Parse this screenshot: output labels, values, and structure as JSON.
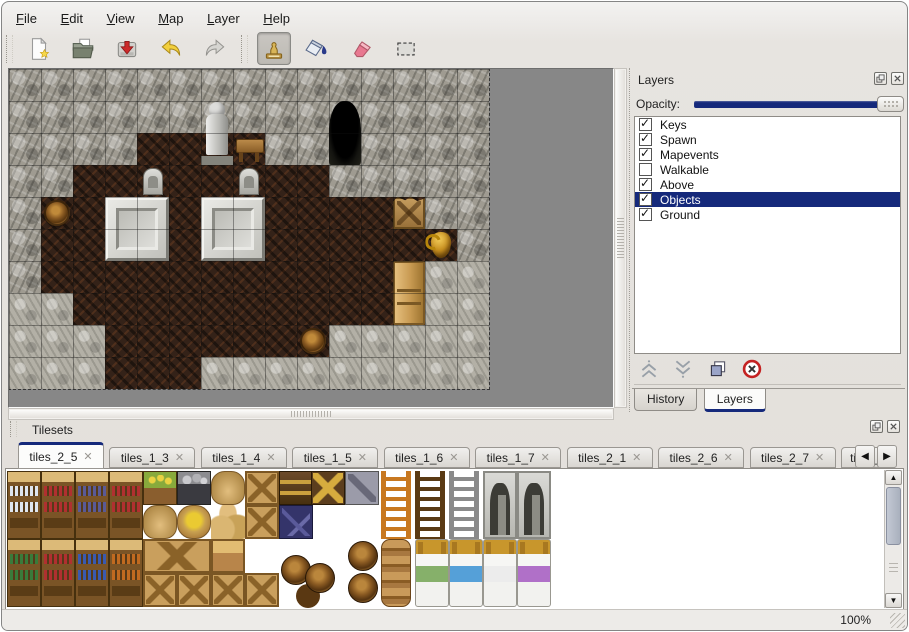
{
  "menu": {
    "items": [
      {
        "key": "F",
        "rest": "ile"
      },
      {
        "key": "E",
        "rest": "dit"
      },
      {
        "key": "V",
        "rest": "iew"
      },
      {
        "key": "M",
        "rest": "ap"
      },
      {
        "key": "L",
        "rest": "ayer"
      },
      {
        "key": "H",
        "rest": "elp"
      }
    ]
  },
  "toolbar": {
    "buttons": [
      {
        "icon": "new-file-icon"
      },
      {
        "icon": "open-folder-icon"
      },
      {
        "icon": "save-icon"
      },
      {
        "icon": "undo-icon"
      },
      {
        "icon": "redo-icon"
      },
      {
        "icon": "stamp-tool-icon",
        "active": true
      },
      {
        "icon": "fill-tool-icon"
      },
      {
        "icon": "eraser-tool-icon"
      },
      {
        "icon": "select-tool-icon"
      }
    ]
  },
  "layers_panel": {
    "title": "Layers",
    "opacity_label": "Opacity:",
    "opacity_percent": 100,
    "items": [
      {
        "label": "Keys",
        "checked": true,
        "selected": false
      },
      {
        "label": "Spawn",
        "checked": true,
        "selected": false
      },
      {
        "label": "Mapevents",
        "checked": true,
        "selected": false
      },
      {
        "label": "Walkable",
        "checked": false,
        "selected": false
      },
      {
        "label": "Above",
        "checked": true,
        "selected": false
      },
      {
        "label": "Objects",
        "checked": true,
        "selected": true
      },
      {
        "label": "Ground",
        "checked": true,
        "selected": false
      }
    ],
    "buttons": [
      "move-layer-up",
      "move-layer-down",
      "duplicate-layer",
      "delete-layer"
    ],
    "tabs": [
      {
        "label": "History",
        "active": false
      },
      {
        "label": "Layers",
        "active": true
      }
    ]
  },
  "tilesets_panel": {
    "title": "Tilesets",
    "tabs": [
      {
        "label": "tiles_2_5",
        "active": true
      },
      {
        "label": "tiles_1_3",
        "active": false
      },
      {
        "label": "tiles_1_4",
        "active": false
      },
      {
        "label": "tiles_1_5",
        "active": false
      },
      {
        "label": "tiles_1_6",
        "active": false
      },
      {
        "label": "tiles_1_7",
        "active": false
      },
      {
        "label": "tiles_2_1",
        "active": false
      },
      {
        "label": "tiles_2_6",
        "active": false
      },
      {
        "label": "tiles_2_7",
        "active": false
      },
      {
        "label": "tiles_",
        "active": false
      }
    ]
  },
  "status": {
    "zoom": "100%"
  },
  "colors": {
    "accent": "#15297b",
    "canvas_bg": "#878787"
  },
  "map": {
    "tile_size": 32,
    "legend": {
      "W": "rock-wall",
      "F": "wood-floor",
      "R": "rock-ground"
    },
    "grid": [
      "WWWWWWWWWWWWWWW",
      "WWWWWWWWWWWWWWW",
      "WWWWFFFFWWWWWWW",
      "WWFFFFFFFFWWWWW",
      "WFFFFFFFFFFFFWW",
      "WFFFFFFFFFFFFFW",
      "WFFFFFFFFFFFFRR",
      "RRFFFFFFFFFFFRR",
      "RRRFFFFFFFRRRRR",
      "RRRFFFRRRRRRRRR"
    ],
    "objects": [
      {
        "type": "statue",
        "col": 6,
        "row": 1,
        "w": 1,
        "h": 2
      },
      {
        "type": "table",
        "col": 7,
        "row": 2,
        "w": 1,
        "h": 1
      },
      {
        "type": "cave",
        "col": 10,
        "row": 1,
        "w": 1,
        "h": 2
      },
      {
        "type": "tombstone",
        "col": 4,
        "row": 3,
        "w": 1,
        "h": 1
      },
      {
        "type": "tombstone",
        "col": 7,
        "row": 3,
        "w": 1,
        "h": 1
      },
      {
        "type": "platform",
        "col": 3,
        "row": 4,
        "w": 2,
        "h": 2
      },
      {
        "type": "platform",
        "col": 6,
        "row": 4,
        "w": 2,
        "h": 2
      },
      {
        "type": "barrel",
        "col": 1,
        "row": 4,
        "w": 1,
        "h": 1
      },
      {
        "type": "crate-broken",
        "col": 12,
        "row": 4,
        "w": 1,
        "h": 1
      },
      {
        "type": "vase",
        "col": 13,
        "row": 5,
        "w": 1,
        "h": 1
      },
      {
        "type": "cabinet",
        "col": 12,
        "row": 6,
        "w": 1,
        "h": 2
      },
      {
        "type": "barrel",
        "col": 9,
        "row": 8,
        "w": 1,
        "h": 1
      }
    ]
  },
  "palette": {
    "items": [
      {
        "type": "shelf",
        "x": 0,
        "y": 0,
        "w": 34,
        "h": 68,
        "accent": "#dfe5ee"
      },
      {
        "type": "shelf",
        "x": 34,
        "y": 0,
        "w": 34,
        "h": 68,
        "accent": "#b03030"
      },
      {
        "type": "shelf",
        "x": 68,
        "y": 0,
        "w": 34,
        "h": 68,
        "accent": "#5a5a96"
      },
      {
        "type": "shelf",
        "x": 102,
        "y": 0,
        "w": 34,
        "h": 68,
        "accent": "#b03030"
      },
      {
        "type": "planter",
        "x": 136,
        "y": 0
      },
      {
        "type": "orecart",
        "x": 170,
        "y": 0
      },
      {
        "type": "sack",
        "x": 204,
        "y": 0
      },
      {
        "type": "crate",
        "x": 238,
        "y": 0
      },
      {
        "type": "chestdark",
        "x": 272,
        "y": 0
      },
      {
        "type": "chestgold",
        "x": 304,
        "y": 0
      },
      {
        "type": "cratemark",
        "x": 338,
        "y": 0
      },
      {
        "type": "sackbig",
        "x": 136,
        "y": 34
      },
      {
        "type": "sackopen",
        "x": 170,
        "y": 34
      },
      {
        "type": "sackpile",
        "x": 204,
        "y": 34
      },
      {
        "type": "crate",
        "x": 238,
        "y": 34
      },
      {
        "type": "cratenavy",
        "x": 272,
        "y": 34
      },
      {
        "type": "ladder",
        "x": 374,
        "y": 0,
        "w": 30,
        "h": 68,
        "accent": "#c87820"
      },
      {
        "type": "ladder",
        "x": 408,
        "y": 0,
        "w": 30,
        "h": 68,
        "accent": "#5a3a14"
      },
      {
        "type": "ladder",
        "x": 442,
        "y": 0,
        "w": 30,
        "h": 68,
        "accent": "#8a8a8a"
      },
      {
        "type": "door",
        "x": 476,
        "y": 0,
        "w": 34,
        "h": 68
      },
      {
        "type": "door",
        "x": 510,
        "y": 0,
        "w": 34,
        "h": 68
      },
      {
        "type": "shelf",
        "x": 0,
        "y": 68,
        "w": 34,
        "h": 68,
        "accent": "#3a7a3a"
      },
      {
        "type": "shelf",
        "x": 34,
        "y": 68,
        "w": 34,
        "h": 68,
        "accent": "#b03030"
      },
      {
        "type": "shelf",
        "x": 68,
        "y": 68,
        "w": 34,
        "h": 68,
        "accent": "#3a5ab0"
      },
      {
        "type": "shelf",
        "x": 102,
        "y": 68,
        "w": 34,
        "h": 68,
        "accent": "#c06a20"
      },
      {
        "type": "crate",
        "x": 136,
        "y": 68,
        "w": 68,
        "h": 34
      },
      {
        "type": "chest",
        "x": 204,
        "y": 68
      },
      {
        "type": "crate",
        "x": 136,
        "y": 102
      },
      {
        "type": "crate",
        "x": 170,
        "y": 102
      },
      {
        "type": "crate",
        "x": 204,
        "y": 102
      },
      {
        "type": "crate",
        "x": 238,
        "y": 102
      },
      {
        "type": "barrelcluster",
        "x": 272,
        "y": 80,
        "w": 60,
        "h": 58
      },
      {
        "type": "barrel2",
        "x": 338,
        "y": 68,
        "w": 34,
        "h": 68
      },
      {
        "type": "pots",
        "x": 374,
        "y": 68,
        "w": 30,
        "h": 68
      },
      {
        "type": "bed",
        "x": 408,
        "y": 68,
        "w": 34,
        "h": 68,
        "accent": "#86b06a"
      },
      {
        "type": "bed",
        "x": 442,
        "y": 68,
        "w": 34,
        "h": 68,
        "accent": "#55a0d8"
      },
      {
        "type": "bed",
        "x": 476,
        "y": 68,
        "w": 34,
        "h": 68,
        "accent": "#ececec"
      },
      {
        "type": "bed",
        "x": 510,
        "y": 68,
        "w": 34,
        "h": 68,
        "accent": "#b070c8"
      }
    ]
  }
}
